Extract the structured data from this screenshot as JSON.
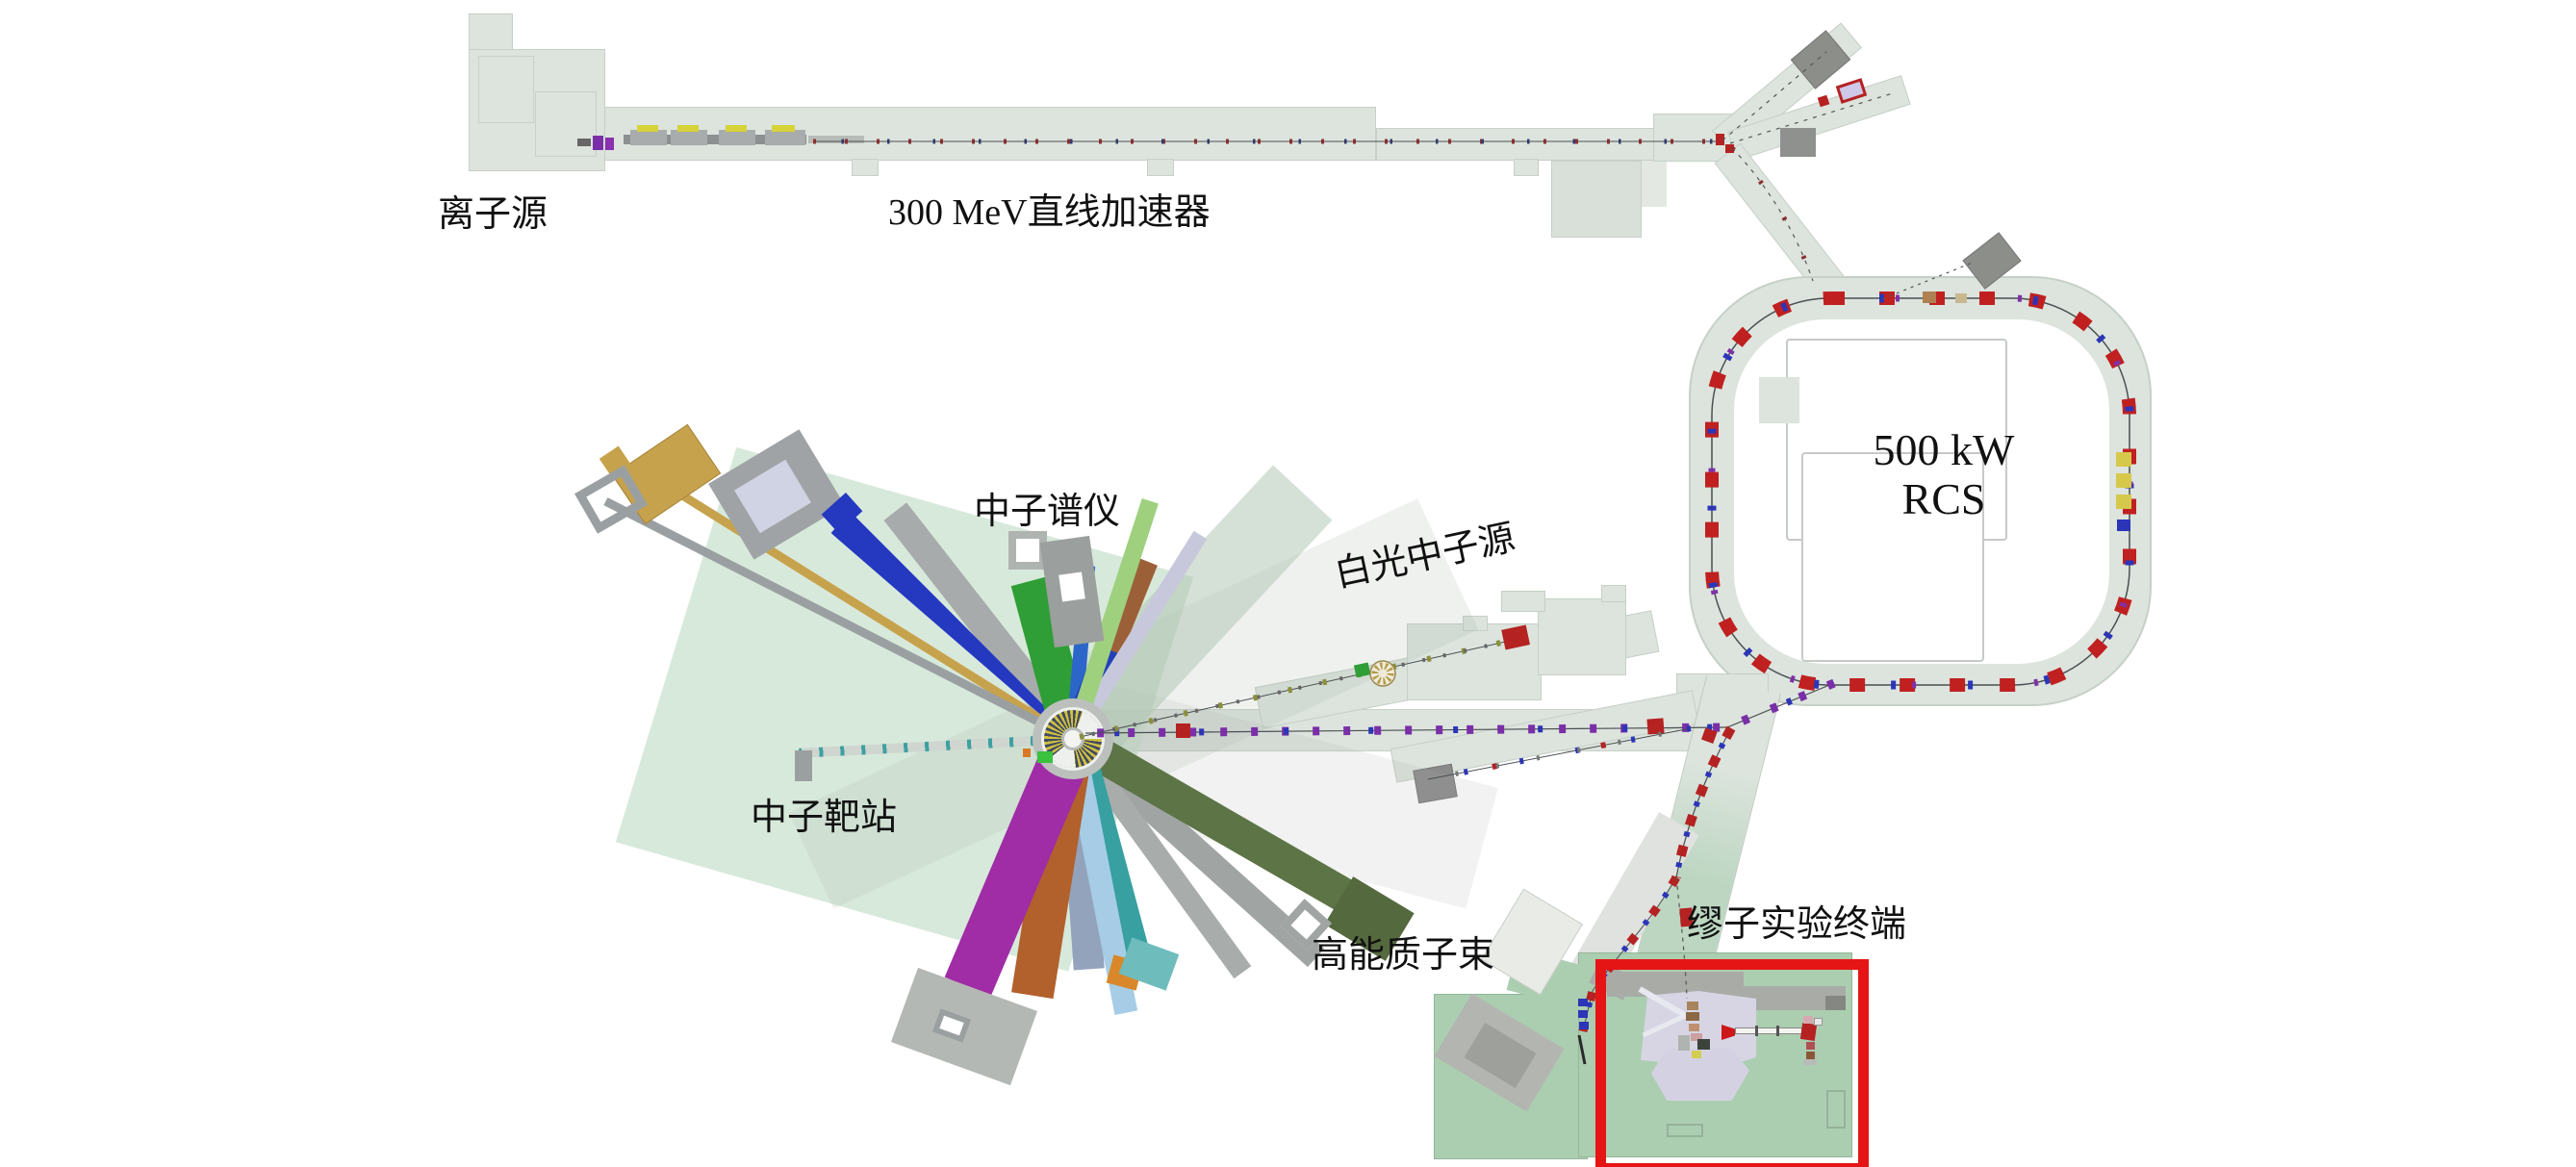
{
  "diagram": {
    "labels": {
      "ion_source": "离子源",
      "linac": "300 MeV直线加速器",
      "spectrometers": "中子谱仪",
      "white_neutron_source": "白光中子源",
      "target_station": "中子靶站",
      "rcs_power": "500 kW",
      "rcs_name": "RCS",
      "proton_beam": "高能质子束",
      "muon_terminal": "缪子实验终端"
    },
    "colors": {
      "highlight_box": "#e51515",
      "dipole_red": "#c02020",
      "quad_blue": "#2c35b8",
      "sextupole_purple": "#7a2fa8",
      "rf_yellow": "#d6c84a",
      "tunnel_green": "#dce4dd",
      "muon_hall_green": "#abceb1",
      "floor_lavender": "#d7d5e4",
      "target_slab_green": "#cde3d2"
    }
  }
}
